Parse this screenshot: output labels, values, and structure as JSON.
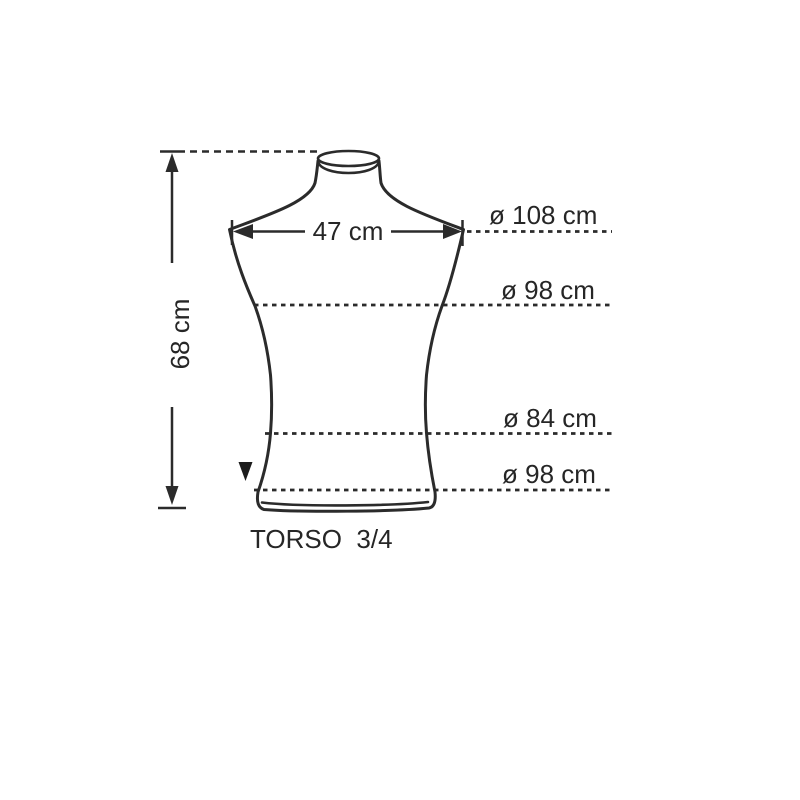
{
  "diagram": {
    "title": "TORSO  3/4",
    "measurements": {
      "height": "68 cm",
      "shoulder_width": "47 cm",
      "circumferences": [
        {
          "name": "shoulders",
          "label": "ø 108 cm"
        },
        {
          "name": "chest",
          "label": "ø 98 cm"
        },
        {
          "name": "waist",
          "label": "ø 84 cm"
        },
        {
          "name": "hip",
          "label": "ø 98 cm"
        }
      ]
    },
    "colors": {
      "line": "#2b2b2b",
      "text": "#262626",
      "background": "#ffffff"
    }
  }
}
